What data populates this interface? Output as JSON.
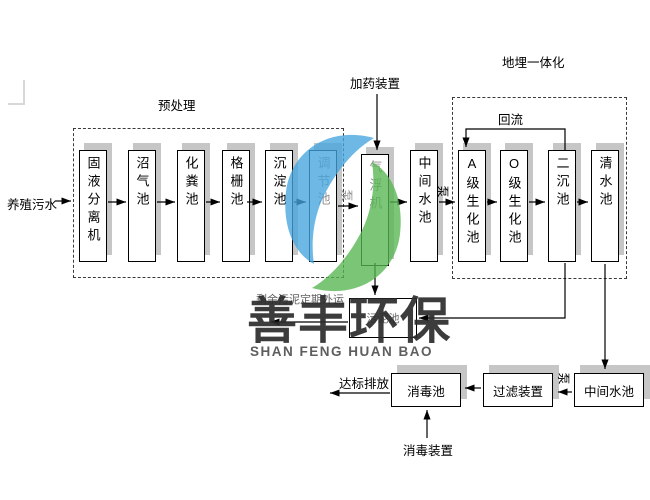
{
  "diagram": {
    "labels": {
      "input": "养殖污水",
      "pretreatment": "预处理",
      "dosing_device": "加药装置",
      "buried_integration": "地埋一体化",
      "reflux": "回流",
      "pump": "泵",
      "sludge_note": "剩余污泥定期外运",
      "discharge": "达标排放",
      "disinfect_device": "消毒装置"
    },
    "process_boxes": [
      "固液分离机",
      "沼气池",
      "化粪池",
      "格栅池",
      "沉淀池",
      "调节池",
      "气浮机",
      "中间水池",
      "A级生化池",
      "O级生化池",
      "二沉池",
      "清水池"
    ],
    "sludge_box": "污泥池",
    "bottom_boxes": [
      "消毒池",
      "过滤装置",
      "中间水池"
    ]
  },
  "watermark": {
    "title": "善丰环保",
    "subtitle": "SHAN FENG HUAN BAO",
    "logo_blue": "#45a5de",
    "logo_green": "#57b651"
  },
  "colors": {
    "box_border": "#000000",
    "box_shadow": "#c6c6c6",
    "washed_text": "#8f8f8f",
    "line": "#000000",
    "corner_mark": "#d8d8d8"
  }
}
